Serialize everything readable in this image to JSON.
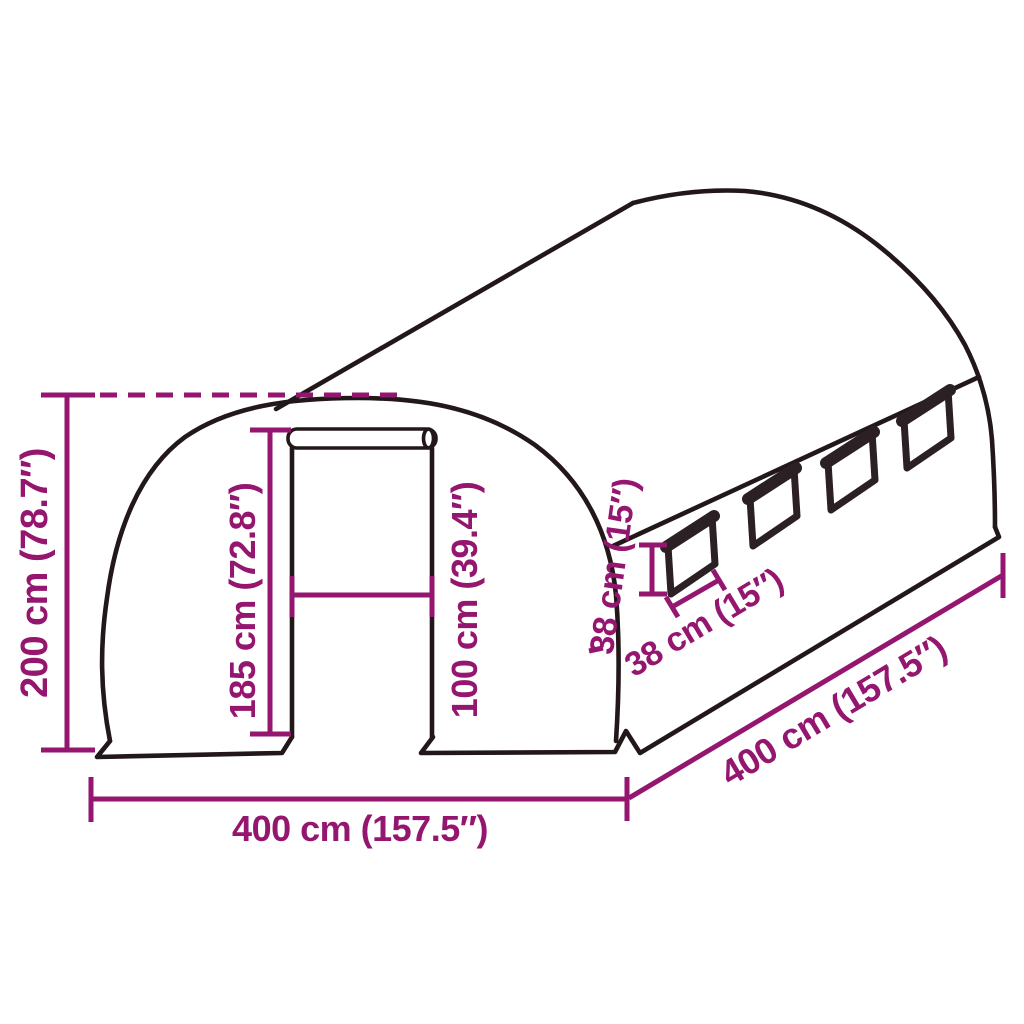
{
  "diagram": {
    "type": "product-dimension-diagram",
    "subject": "tunnel greenhouse with roll-up door and side windows",
    "background": "#ffffff",
    "colors": {
      "outline": "#221719",
      "dimension": "#94166F"
    },
    "windows_count": 4,
    "dimensions": {
      "total_height": {
        "label": "200 cm (78.7″)"
      },
      "door_height": {
        "label": "185 cm (72.8″)"
      },
      "door_width": {
        "label": "100 cm (39.4″)"
      },
      "window_height": {
        "label": "38 cm (15″)"
      },
      "window_width": {
        "label": "38 cm (15″)"
      },
      "front_width": {
        "label": "400 cm (157.5″)"
      },
      "side_length": {
        "label": "400 cm (157.5″)"
      }
    }
  }
}
